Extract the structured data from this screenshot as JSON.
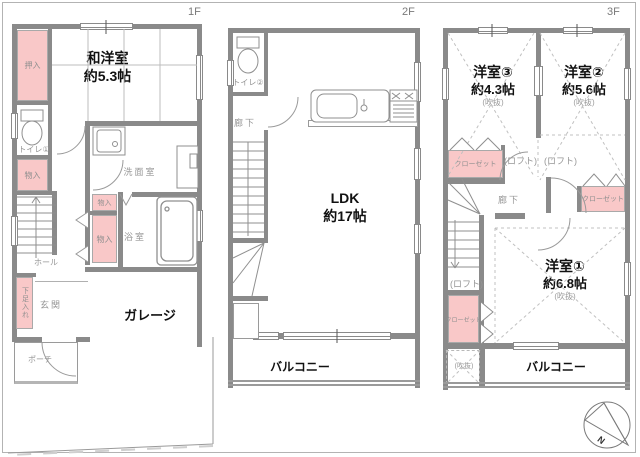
{
  "plan_title": "3-story house floor plan",
  "colors": {
    "wall": "#8a8a8a",
    "closet_fill": "#f9c8c8",
    "label_gray": "#969696",
    "room_text": "#111111",
    "border": "#b3b3b3"
  },
  "f1": {
    "tag": "1F",
    "washitsu_name": "和洋室",
    "washitsu_size": "約5.3帖",
    "oshiire": "押入",
    "toilet": "トイレ①",
    "mono_a": "物入",
    "mono_b": "物入",
    "mono_c": "物入",
    "senmen": "洗面室",
    "yokushitsu": "浴室",
    "hall": "ホール",
    "shoe": "下足入れ",
    "genkan": "玄関",
    "porch": "ポーチ",
    "garage": "ガレージ"
  },
  "f2": {
    "tag": "2F",
    "toilet": "トイレ②",
    "rouka": "廊下",
    "ldk_name": "LDK",
    "ldk_size": "約17帖",
    "balcony": "バルコニー"
  },
  "f3": {
    "tag": "3F",
    "y3_name": "洋室③",
    "y3_size": "約4.3帖",
    "y3_note": "(吹抜)",
    "y2_name": "洋室②",
    "y2_size": "約5.6帖",
    "y2_note": "(吹抜)",
    "y1_name": "洋室①",
    "y1_size": "約6.8帖",
    "y1_note": "(吹抜)",
    "closet_a": "クローゼット",
    "closet_b": "クローゼット",
    "closet_c": "クローゼット",
    "loft_a": "(ロフト)",
    "loft_b": "(ロフト)",
    "loft_c": "(ロフト)",
    "rouka": "廊下",
    "void_label": "(吹抜)",
    "balcony": "バルコニー"
  },
  "compass": {
    "label": "N"
  }
}
